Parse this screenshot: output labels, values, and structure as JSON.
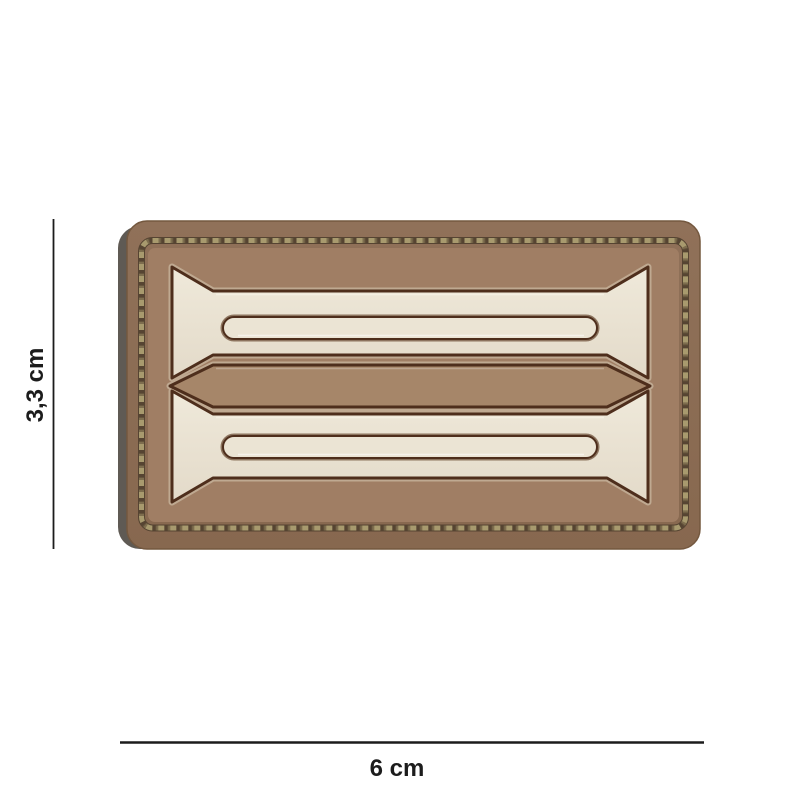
{
  "page": {
    "type": "product-photo",
    "subject": "3D PVC rubber morale patch, desert/coyote brown ribbon-bar design with simulated stitched border"
  },
  "product_image": {
    "dimension_annotations": {
      "height": {
        "label": "3,3 cm"
      },
      "width": {
        "label": "6 cm"
      }
    }
  },
  "colors": {
    "background": "#ffffff",
    "annotation": "#1c1c1c",
    "backing": "#5f5a54",
    "patch_border": "#907159",
    "patch_border_edge": "#74583f",
    "patch_field": "#a07e64",
    "middle_band": "#a68669",
    "ribbon_cream": "#e3dac9",
    "ribbon_cream_light": "#efe9da",
    "slot_fill": "#ebe4d4",
    "outline_dark": "#4e2e1c",
    "groove": "#7b604a",
    "bevel_light": "#d9cdb6",
    "stitch_khaki": "#a89a6e",
    "stitch_dark": "#564432"
  }
}
